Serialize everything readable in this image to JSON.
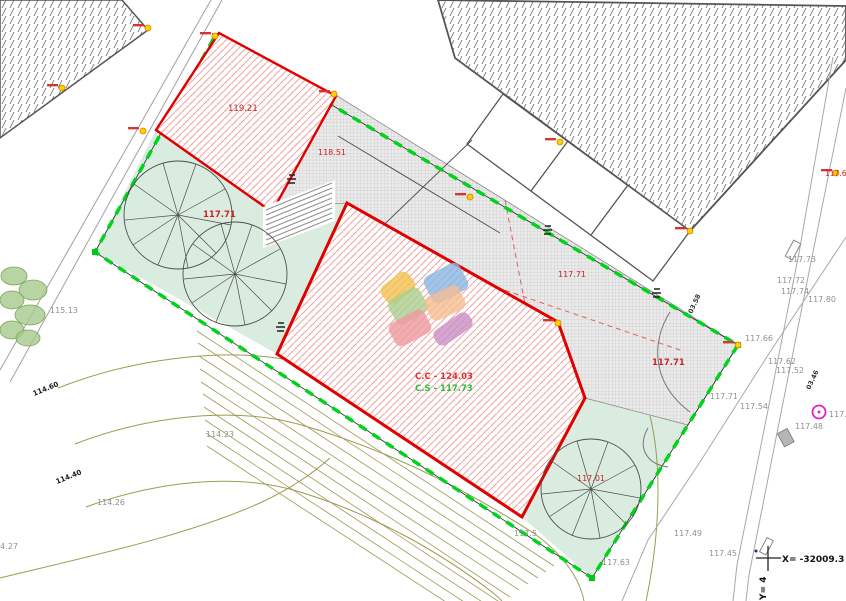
{
  "drawing": {
    "type_label": "site-plan"
  },
  "colors": {
    "boundary_green": "#00d41a",
    "building_red": "#e00000",
    "red_hatch": "#f0a3a3",
    "mint_area": "#d9ecdf",
    "gray_label": "#909090",
    "red_label": "#cc2323",
    "green_label": "#2fbf3f",
    "contour_olive": "#9b9b52",
    "marker_yellow": "#ffcf00",
    "magenta_symbol": "#e320c6"
  },
  "coordinate_marker": {
    "x_text": "X= -32009.3",
    "y_text": "Y= 4"
  },
  "labels": [
    {
      "name": "elev-115-13",
      "text": "115.13",
      "x": 50,
      "y": 313,
      "fill": "#909090",
      "size": 8,
      "rot": 0,
      "weight": "normal"
    },
    {
      "name": "elev-114-23",
      "text": "114.23",
      "x": 206,
      "y": 437,
      "fill": "#909090",
      "size": 8,
      "rot": 0,
      "weight": "normal"
    },
    {
      "name": "elev-114-26",
      "text": "114.26",
      "x": 97,
      "y": 505,
      "fill": "#909090",
      "size": 8,
      "rot": 0,
      "weight": "normal"
    },
    {
      "name": "elev-114-27",
      "text": "114.27",
      "x": -10,
      "y": 549,
      "fill": "#909090",
      "size": 8,
      "rot": 0,
      "weight": "normal"
    },
    {
      "name": "contour-114-60",
      "text": "114.60",
      "x": 34,
      "y": 396,
      "fill": "#1a1a1a",
      "size": 7,
      "rot": -22,
      "weight": "600"
    },
    {
      "name": "contour-114-40",
      "text": "114.40",
      "x": 57,
      "y": 484,
      "fill": "#1a1a1a",
      "size": 7,
      "rot": -22,
      "weight": "600"
    },
    {
      "name": "building1-area",
      "text": "119.21",
      "x": 228,
      "y": 111,
      "fill": "#cc2323",
      "size": 8.5,
      "rot": 0,
      "weight": "normal"
    },
    {
      "name": "terrace-area",
      "text": "118.51",
      "x": 318,
      "y": 155,
      "fill": "#cc2323",
      "size": 8,
      "rot": 0,
      "weight": "normal"
    },
    {
      "name": "mint-elev-117-71",
      "text": "117.71",
      "x": 203,
      "y": 217,
      "fill": "#cc2323",
      "size": 8.5,
      "rot": 0,
      "weight": "bold"
    },
    {
      "name": "terrace-elev-117-71",
      "text": "117.71",
      "x": 558,
      "y": 277,
      "fill": "#cc2323",
      "size": 8,
      "rot": 0,
      "weight": "normal"
    },
    {
      "name": "right-elev-117-71-red",
      "text": "117.71",
      "x": 652,
      "y": 365,
      "fill": "#cc2323",
      "size": 8.5,
      "rot": 0,
      "weight": "bold"
    },
    {
      "name": "tree-elev-117-01",
      "text": "117.01",
      "x": 577,
      "y": 481,
      "fill": "#cc2323",
      "size": 8,
      "rot": 0,
      "weight": "normal"
    },
    {
      "name": "ridge-elevation",
      "text": "C.C - 124.03",
      "x": 415,
      "y": 379,
      "fill": "#e03030",
      "size": 8.5,
      "rot": 0,
      "weight": "bold"
    },
    {
      "name": "ground-elevation",
      "text": "C.S - 117.73",
      "x": 415,
      "y": 391,
      "fill": "#2fbf3f",
      "size": 8.5,
      "rot": 0,
      "weight": "bold"
    },
    {
      "name": "right-edge-117-6",
      "text": "117.6",
      "x": 825,
      "y": 176,
      "fill": "#cc2323",
      "size": 7.5,
      "rot": 0,
      "weight": "normal"
    },
    {
      "name": "elev-117-73",
      "text": "117.73",
      "x": 788,
      "y": 262,
      "fill": "#909090",
      "size": 8,
      "rot": 0,
      "weight": "normal"
    },
    {
      "name": "elev-117-72",
      "text": "117.72",
      "x": 777,
      "y": 283,
      "fill": "#909090",
      "size": 8,
      "rot": 0,
      "weight": "normal"
    },
    {
      "name": "elev-117-74",
      "text": "117.74",
      "x": 781,
      "y": 294,
      "fill": "#909090",
      "size": 8,
      "rot": 0,
      "weight": "normal"
    },
    {
      "name": "elev-117-80",
      "text": "117.80",
      "x": 808,
      "y": 302,
      "fill": "#909090",
      "size": 8,
      "rot": 0,
      "weight": "normal"
    },
    {
      "name": "elev-117-66",
      "text": "117.66",
      "x": 745,
      "y": 341,
      "fill": "#909090",
      "size": 8,
      "rot": 0,
      "weight": "normal"
    },
    {
      "name": "elev-117-62",
      "text": "117.62",
      "x": 768,
      "y": 364,
      "fill": "#909090",
      "size": 8,
      "rot": 0,
      "weight": "normal"
    },
    {
      "name": "elev-117-52",
      "text": "117.52",
      "x": 776,
      "y": 373,
      "fill": "#909090",
      "size": 8,
      "rot": 0,
      "weight": "normal"
    },
    {
      "name": "elev-117-71-gray",
      "text": "117.71",
      "x": 710,
      "y": 399,
      "fill": "#909090",
      "size": 8,
      "rot": 0,
      "weight": "normal"
    },
    {
      "name": "elev-117-54",
      "text": "117.54",
      "x": 740,
      "y": 409,
      "fill": "#909090",
      "size": 8,
      "rot": 0,
      "weight": "normal"
    },
    {
      "name": "elev-117-48",
      "text": "117.48",
      "x": 795,
      "y": 429,
      "fill": "#909090",
      "size": 8,
      "rot": 0,
      "weight": "normal"
    },
    {
      "name": "elev-117-5-right",
      "text": "117.5",
      "x": 829,
      "y": 417,
      "fill": "#909090",
      "size": 8,
      "rot": 0,
      "weight": "normal"
    },
    {
      "name": "elev-117-45",
      "text": "117.45",
      "x": 709,
      "y": 556,
      "fill": "#909090",
      "size": 8,
      "rot": 0,
      "weight": "normal"
    },
    {
      "name": "elev-117-49",
      "text": "117.49",
      "x": 674,
      "y": 536,
      "fill": "#909090",
      "size": 8,
      "rot": 0,
      "weight": "normal"
    },
    {
      "name": "elev-117-63",
      "text": "117.63",
      "x": 602,
      "y": 565,
      "fill": "#909090",
      "size": 8,
      "rot": 0,
      "weight": "normal"
    },
    {
      "name": "elev-117-5-bottom",
      "text": "117.5",
      "x": 514,
      "y": 536,
      "fill": "#909090",
      "size": 8,
      "rot": 0,
      "weight": "normal"
    },
    {
      "name": "pipe-03-58",
      "text": "03.58",
      "x": 692,
      "y": 314,
      "fill": "#333333",
      "size": 6.5,
      "rot": -65,
      "weight": "600"
    },
    {
      "name": "pipe-03-46",
      "text": "03.46",
      "x": 810,
      "y": 390,
      "fill": "#333333",
      "size": 6.5,
      "rot": -65,
      "weight": "600"
    },
    {
      "name": "coord-x-label",
      "text": "X= -32009.3",
      "x": 782,
      "y": 562,
      "fill": "#111111",
      "size": 9,
      "rot": 0,
      "weight": "600"
    },
    {
      "name": "coord-y-label",
      "text": "Y= 4",
      "x": 766,
      "y": 600,
      "fill": "#111111",
      "size": 9,
      "rot": -90,
      "weight": "600"
    }
  ],
  "survey_markers": [
    {
      "x": 148,
      "y": 28
    },
    {
      "x": 62,
      "y": 88
    },
    {
      "x": 143,
      "y": 131
    },
    {
      "x": 215,
      "y": 36
    },
    {
      "x": 334,
      "y": 94
    },
    {
      "x": 560,
      "y": 142
    },
    {
      "x": 690,
      "y": 231
    },
    {
      "x": 836,
      "y": 173
    },
    {
      "x": 470,
      "y": 197
    },
    {
      "x": 738,
      "y": 345
    },
    {
      "x": 558,
      "y": 323
    }
  ],
  "logo": {
    "shapes": [
      {
        "name": "logo-petal-yellow",
        "cx": 398,
        "cy": 288,
        "w": 34,
        "h": 22,
        "rot": -38,
        "fill": "#f2c24e"
      },
      {
        "name": "logo-petal-green",
        "cx": 408,
        "cy": 306,
        "w": 36,
        "h": 28,
        "rot": -30,
        "fill": "#abce8e"
      },
      {
        "name": "logo-petal-pink",
        "cx": 410,
        "cy": 328,
        "w": 40,
        "h": 26,
        "rot": -28,
        "fill": "#ee9a9e"
      },
      {
        "name": "logo-petal-blue",
        "cx": 446,
        "cy": 283,
        "w": 40,
        "h": 30,
        "rot": -28,
        "fill": "#8ab6e2"
      },
      {
        "name": "logo-petal-peach",
        "cx": 445,
        "cy": 303,
        "w": 38,
        "h": 26,
        "rot": -25,
        "fill": "#f5bd92"
      },
      {
        "name": "logo-petal-purple",
        "cx": 453,
        "cy": 329,
        "w": 42,
        "h": 18,
        "rot": -35,
        "fill": "#c98fc6"
      }
    ]
  }
}
